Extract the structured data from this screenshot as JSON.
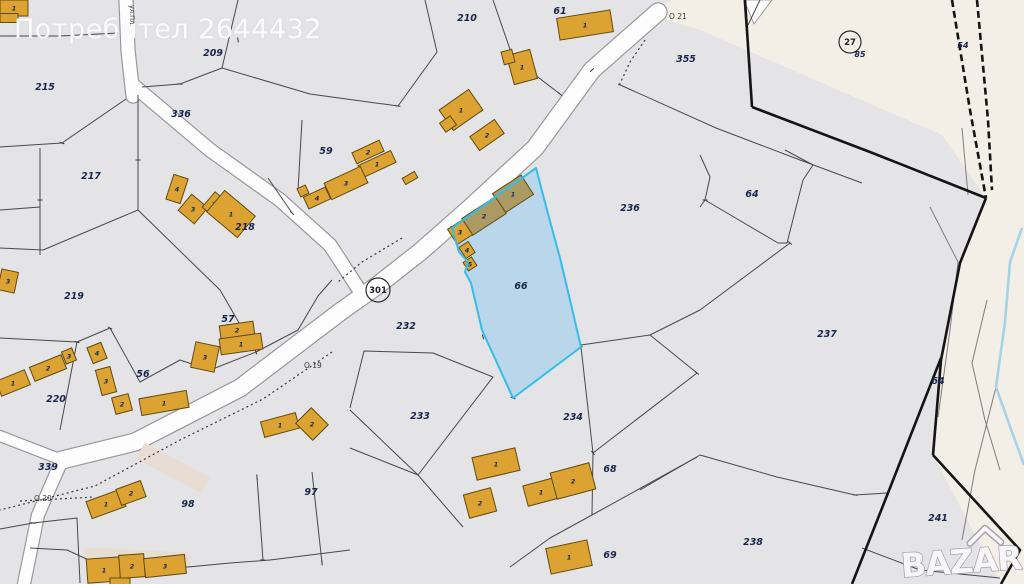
{
  "watermark": {
    "text": "Потребител 2644432"
  },
  "brand": {
    "text": "BAZAR"
  },
  "street": {
    "text": "ул.Пл.",
    "x": 130,
    "y": 5
  },
  "colors": {
    "base": "#e4e3e5",
    "cream": "#f3efe6",
    "road_fill": "#fdfdfd",
    "road_edge": "#98989c",
    "line": "#48484d",
    "thick": "#141414",
    "dotted": "#3a3a3a",
    "cream_line": "#7d7d81",
    "water": "#a5d3e8",
    "beige": "#e7ddd2",
    "building": "#dda332",
    "building_stroke": "#5f4b0e",
    "building_selected": "#ab9b63",
    "selection_fill": "#b7d5eb",
    "selection_stroke": "#35bdea",
    "label": "#17264d",
    "wedge": "#fdfdfd"
  },
  "parcel_labels": [
    {
      "t": "215",
      "x": 45,
      "y": 87
    },
    {
      "t": "209",
      "x": 213,
      "y": 53
    },
    {
      "t": "210",
      "x": 467,
      "y": 18
    },
    {
      "t": "61",
      "x": 560,
      "y": 11
    },
    {
      "t": "355",
      "x": 686,
      "y": 59
    },
    {
      "t": "336",
      "x": 181,
      "y": 114
    },
    {
      "t": "217",
      "x": 91,
      "y": 176
    },
    {
      "t": "218",
      "x": 245,
      "y": 227
    },
    {
      "t": "219",
      "x": 74,
      "y": 296
    },
    {
      "t": "59",
      "x": 326,
      "y": 151
    },
    {
      "t": "57",
      "x": 228,
      "y": 319
    },
    {
      "t": "56",
      "x": 143,
      "y": 374
    },
    {
      "t": "220",
      "x": 56,
      "y": 399
    },
    {
      "t": "339",
      "x": 48,
      "y": 467
    },
    {
      "t": "98",
      "x": 188,
      "y": 504
    },
    {
      "t": "97",
      "x": 311,
      "y": 492
    },
    {
      "t": "232",
      "x": 406,
      "y": 326
    },
    {
      "t": "233",
      "x": 420,
      "y": 416
    },
    {
      "t": "234",
      "x": 573,
      "y": 417
    },
    {
      "t": "66",
      "x": 521,
      "y": 286
    },
    {
      "t": "236",
      "x": 630,
      "y": 208
    },
    {
      "t": "237",
      "x": 827,
      "y": 334
    },
    {
      "t": "238",
      "x": 753,
      "y": 542
    },
    {
      "t": "241",
      "x": 938,
      "y": 518
    },
    {
      "t": "68",
      "x": 610,
      "y": 469
    },
    {
      "t": "69",
      "x": 610,
      "y": 555
    },
    {
      "t": "64",
      "x": 752,
      "y": 194
    },
    {
      "t": "64",
      "x": 938,
      "y": 381
    }
  ],
  "small_labels": [
    {
      "t": "54",
      "x": 963,
      "y": 45
    },
    {
      "t": "85",
      "x": 860,
      "y": 54
    }
  ],
  "point_labels": [
    {
      "t": "O 21",
      "x": 669,
      "y": 17
    },
    {
      "t": "O 19",
      "x": 304,
      "y": 366
    },
    {
      "t": "O 20",
      "x": 34,
      "y": 499
    }
  ],
  "badges": [
    {
      "t": "301",
      "x": 378,
      "y": 290,
      "r": 12
    },
    {
      "t": "27",
      "x": 850,
      "y": 42,
      "r": 11
    }
  ],
  "geometry": {
    "cream": "648,14 672,0 1024,0 1024,584 1001,584 933,455 941,360 960,263 986,198 942,135 700,30",
    "wedge": "744,0 772,0 754,24",
    "roads": [
      {
        "p": "658,12 592,70 535,148 470,208 420,252 378,285 340,312 240,388 135,442 62,460",
        "w": 17
      },
      {
        "p": "133,85 210,150 280,200 330,245 358,288",
        "w": 13
      },
      {
        "p": "126,0 128,50 133,96",
        "w": 13
      },
      {
        "p": "62,460 0,436",
        "w": 10
      },
      {
        "p": "62,460 38,515 24,584",
        "w": 12
      }
    ],
    "beige": [
      {
        "x": 173,
        "y": 468,
        "w": 74,
        "h": 18,
        "a": 28
      },
      {
        "x": 137,
        "y": 557,
        "w": 106,
        "h": 14,
        "a": 3
      }
    ],
    "lines": [
      "0,36 60,36 118,33",
      "0,147 62,143 126,99",
      "238,0 222,68 180,84 142,87",
      "222,68 310,94 398,106",
      "398,106 437,52 425,0",
      "493,0 513,58 560,94",
      "40,148 40,255",
      "0,248 43,250 138,210 138,95",
      "138,210 220,290 256,352",
      "0,338 77,342 110,328",
      "77,342 60,430",
      "110,328 140,382 180,360 210,370 256,352",
      "256,352 298,330 318,296 332,280",
      "302,120 298,190",
      "268,178 292,213",
      "0,529 33,523 77,518 80,583",
      "230,563 270,560 350,550",
      "257,477 263,560",
      "312,472 322,563",
      "30,548 67,550 93,562 188,567 230,563",
      "350,408 364,351 433,353 493,377 418,475 350,448",
      "350,410 418,475 463,527",
      "697,373 593,453 592,515",
      "697,457 592,515 550,538 510,567",
      "581,347 593,453",
      "581,345 650,335 697,373",
      "650,335 700,310 790,243",
      "618,84 716,128 800,160 862,183",
      "700,155 710,177 705,200 700,207",
      "785,150 813,165 803,180 787,243",
      "705,200 778,243 787,243",
      "700,455 777,477 855,495 887,493",
      "640,490 700,455",
      "862,548 920,570 1000,578",
      "760,0 748,25",
      "744,0 746,28",
      "0,210 40,207"
    ],
    "cream_lines": [
      "962,128 968,195",
      "930,207 958,262 950,330 938,417",
      "987,300 972,363 985,420 1000,470",
      "996,387 975,470 962,540"
    ],
    "dotted": [
      "645,40 630,62 618,88",
      "332,352 263,399 180,440 95,486 0,510",
      "20,501 95,497",
      "402,238 362,262 338,282"
    ],
    "thick": [
      {
        "p": "745,0 752,107"
      },
      {
        "p": "752,107 870,152 986,198"
      },
      {
        "p": "986,198 960,263 941,360 933,455"
      },
      {
        "p": "933,455 1020,550 1001,584"
      },
      {
        "p": "941,358 888,493 852,584"
      },
      {
        "p": "952,0 970,110 986,198",
        "dash": "7 4"
      },
      {
        "p": "977,0 988,120 992,190",
        "dash": "7 4"
      }
    ],
    "water": "1022,228 1010,262 1005,322 996,387 1012,432 1024,465",
    "selection": "536,168 547,210 560,258 570,300 581,347 513,398 482,330 471,283 465,272 468,262 459,252 452,228",
    "buildings": [
      {
        "x": 14,
        "y": 8,
        "w": 28,
        "h": 16,
        "a": 0,
        "l": "1"
      },
      {
        "x": 9,
        "y": 18,
        "w": 18,
        "h": 9,
        "a": 0,
        "l": ""
      },
      {
        "x": 585,
        "y": 25,
        "w": 54,
        "h": 22,
        "a": -9,
        "l": "1"
      },
      {
        "x": 522,
        "y": 67,
        "w": 24,
        "h": 30,
        "a": -15,
        "l": "1"
      },
      {
        "x": 508,
        "y": 57,
        "w": 11,
        "h": 13,
        "a": -15,
        "l": ""
      },
      {
        "x": 461,
        "y": 110,
        "w": 36,
        "h": 25,
        "a": -35,
        "l": "1"
      },
      {
        "x": 448,
        "y": 124,
        "w": 13,
        "h": 11,
        "a": -35,
        "l": ""
      },
      {
        "x": 487,
        "y": 135,
        "w": 30,
        "h": 17,
        "a": -35,
        "l": "2"
      },
      {
        "x": 368,
        "y": 152,
        "w": 30,
        "h": 12,
        "a": -25,
        "l": "2"
      },
      {
        "x": 377,
        "y": 164,
        "w": 36,
        "h": 13,
        "a": -25,
        "l": "1"
      },
      {
        "x": 346,
        "y": 183,
        "w": 40,
        "h": 18,
        "a": -25,
        "l": "3"
      },
      {
        "x": 317,
        "y": 198,
        "w": 24,
        "h": 13,
        "a": -25,
        "l": "4"
      },
      {
        "x": 303,
        "y": 191,
        "w": 9,
        "h": 9,
        "a": -25,
        "l": ""
      },
      {
        "x": 410,
        "y": 178,
        "w": 14,
        "h": 7,
        "a": -30,
        "l": ""
      },
      {
        "x": 177,
        "y": 189,
        "w": 15,
        "h": 26,
        "a": 18,
        "l": "4"
      },
      {
        "x": 193,
        "y": 209,
        "w": 21,
        "h": 21,
        "a": 40,
        "l": "3"
      },
      {
        "x": 214,
        "y": 204,
        "w": 14,
        "h": 20,
        "a": 40,
        "l": "2"
      },
      {
        "x": 231,
        "y": 214,
        "w": 40,
        "h": 28,
        "a": 40,
        "l": "1"
      },
      {
        "x": 8,
        "y": 281,
        "w": 17,
        "h": 21,
        "a": 12,
        "l": "3"
      },
      {
        "x": 13,
        "y": 383,
        "w": 31,
        "h": 16,
        "a": -22,
        "l": "1"
      },
      {
        "x": 48,
        "y": 368,
        "w": 34,
        "h": 15,
        "a": -22,
        "l": "2"
      },
      {
        "x": 69,
        "y": 356,
        "w": 11,
        "h": 13,
        "a": -22,
        "l": "3"
      },
      {
        "x": 97,
        "y": 353,
        "w": 15,
        "h": 17,
        "a": -22,
        "l": "4"
      },
      {
        "x": 106,
        "y": 381,
        "w": 15,
        "h": 26,
        "a": -15,
        "l": "3"
      },
      {
        "x": 122,
        "y": 404,
        "w": 17,
        "h": 17,
        "a": -15,
        "l": "2"
      },
      {
        "x": 164,
        "y": 403,
        "w": 48,
        "h": 17,
        "a": -10,
        "l": "1"
      },
      {
        "x": 205,
        "y": 357,
        "w": 24,
        "h": 26,
        "a": 12,
        "l": "3"
      },
      {
        "x": 237,
        "y": 330,
        "w": 34,
        "h": 13,
        "a": -8,
        "l": "2"
      },
      {
        "x": 241,
        "y": 344,
        "w": 42,
        "h": 16,
        "a": -8,
        "l": "1"
      },
      {
        "x": 513,
        "y": 194,
        "w": 34,
        "h": 23,
        "a": -33,
        "l": "1",
        "k": 1
      },
      {
        "x": 484,
        "y": 216,
        "w": 40,
        "h": 20,
        "a": -33,
        "l": "2",
        "k": 1
      },
      {
        "x": 460,
        "y": 232,
        "w": 18,
        "h": 18,
        "a": -33,
        "l": "3"
      },
      {
        "x": 467,
        "y": 250,
        "w": 11,
        "h": 13,
        "a": -33,
        "l": "4"
      },
      {
        "x": 470,
        "y": 264,
        "w": 10,
        "h": 10,
        "a": -33,
        "l": "5"
      },
      {
        "x": 280,
        "y": 425,
        "w": 36,
        "h": 16,
        "a": -15,
        "l": "1"
      },
      {
        "x": 312,
        "y": 424,
        "w": 22,
        "h": 24,
        "a": -45,
        "l": "2"
      },
      {
        "x": 106,
        "y": 504,
        "w": 36,
        "h": 18,
        "a": -20,
        "l": "1"
      },
      {
        "x": 131,
        "y": 493,
        "w": 26,
        "h": 17,
        "a": -20,
        "l": "2"
      },
      {
        "x": 496,
        "y": 464,
        "w": 44,
        "h": 23,
        "a": -13,
        "l": "1"
      },
      {
        "x": 480,
        "y": 503,
        "w": 28,
        "h": 24,
        "a": -15,
        "l": "2"
      },
      {
        "x": 541,
        "y": 492,
        "w": 32,
        "h": 21,
        "a": -15,
        "l": "1"
      },
      {
        "x": 573,
        "y": 481,
        "w": 40,
        "h": 27,
        "a": -15,
        "l": "2"
      },
      {
        "x": 569,
        "y": 557,
        "w": 42,
        "h": 26,
        "a": -12,
        "l": "1"
      },
      {
        "x": 104,
        "y": 570,
        "w": 34,
        "h": 24,
        "a": -4,
        "l": "1"
      },
      {
        "x": 132,
        "y": 566,
        "w": 25,
        "h": 23,
        "a": -4,
        "l": "2"
      },
      {
        "x": 165,
        "y": 566,
        "w": 41,
        "h": 19,
        "a": -6,
        "l": "3"
      },
      {
        "x": 120,
        "y": 582,
        "w": 20,
        "h": 8,
        "a": 0,
        "l": ""
      }
    ],
    "ticks": [
      [
        62,
        143,
        20
      ],
      [
        180,
        84,
        10
      ],
      [
        238,
        40,
        80
      ],
      [
        470,
        95,
        40
      ],
      [
        560,
        94,
        40
      ],
      [
        592,
        70,
        -45
      ],
      [
        398,
        106,
        10
      ],
      [
        292,
        213,
        45
      ],
      [
        256,
        352,
        70
      ],
      [
        110,
        328,
        30
      ],
      [
        257,
        477,
        85
      ],
      [
        322,
        563,
        85
      ],
      [
        593,
        453,
        50
      ],
      [
        697,
        373,
        40
      ],
      [
        790,
        243,
        40
      ],
      [
        705,
        200,
        0
      ],
      [
        855,
        495,
        10
      ],
      [
        941,
        360,
        80
      ],
      [
        581,
        345,
        60
      ],
      [
        547,
        210,
        70
      ],
      [
        452,
        228,
        60
      ],
      [
        483,
        337,
        75
      ],
      [
        77,
        342,
        15
      ],
      [
        40,
        200,
        0
      ],
      [
        138,
        160,
        0
      ],
      [
        263,
        560,
        5
      ],
      [
        33,
        523,
        10
      ],
      [
        570,
        300,
        70
      ],
      [
        513,
        398,
        20
      ]
    ]
  }
}
